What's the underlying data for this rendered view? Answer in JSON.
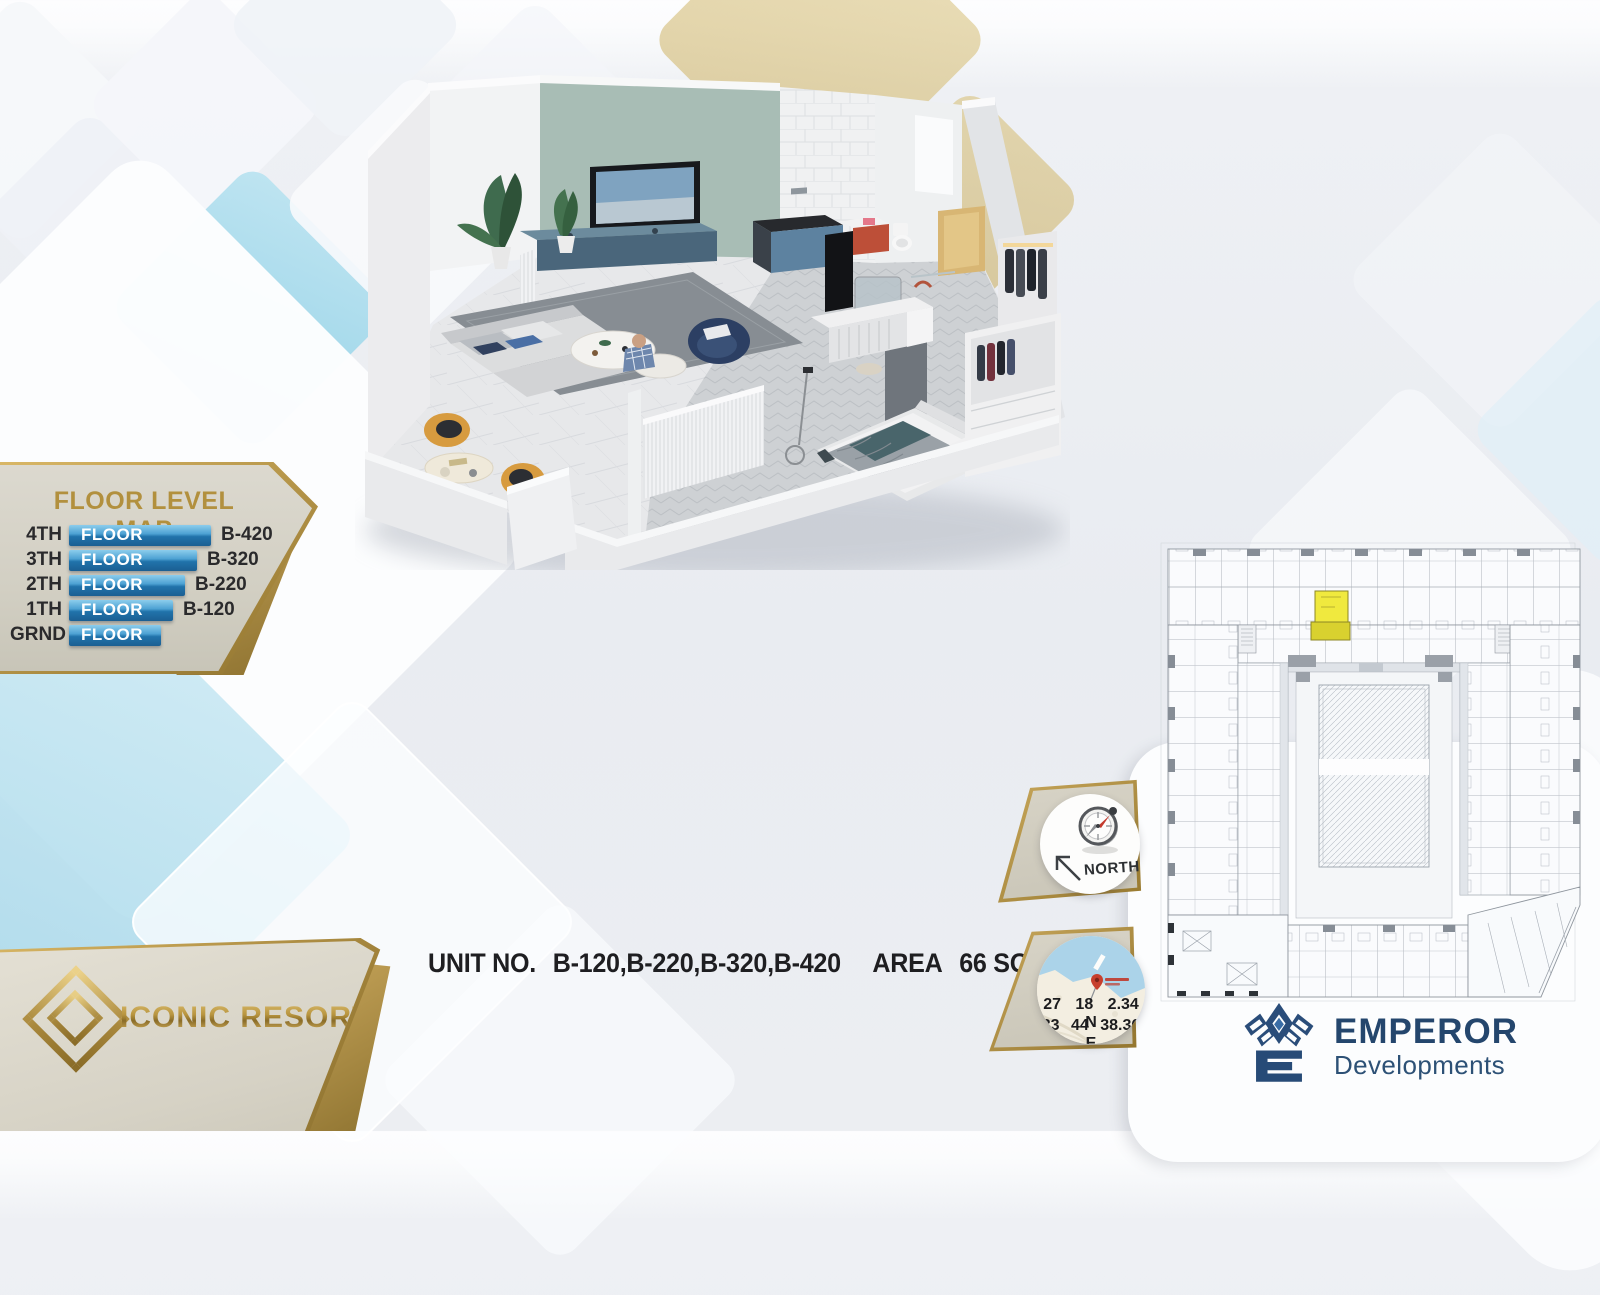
{
  "floor_level_map": {
    "title": "FLOOR LEVEL MAP",
    "rows": [
      {
        "level": "4TH",
        "floor_label": "FLOOR",
        "unit": "B-420"
      },
      {
        "level": "3TH",
        "floor_label": "FLOOR",
        "unit": "B-320"
      },
      {
        "level": "2TH",
        "floor_label": "FLOOR",
        "unit": "B-220"
      },
      {
        "level": "1TH",
        "floor_label": "FLOOR",
        "unit": "B-120"
      },
      {
        "level": "GRND",
        "floor_label": "FLOOR",
        "unit": ""
      }
    ]
  },
  "brand": {
    "name": "ICONIC RESORT"
  },
  "unit_info": {
    "label": "UNIT NO.",
    "units": "B-120,B-220,B-320,B-420",
    "area_label": "AREA",
    "area_value": "66 SQM"
  },
  "compass": {
    "label": "NORTH"
  },
  "location": {
    "line1": "27 18 2.34 N",
    "line2": "33 44 38.36 E"
  },
  "developer": {
    "name": "EMPEROR",
    "division": "Developments"
  },
  "floor_plan": {
    "highlighted_unit_color": "#ede63a"
  },
  "colors": {
    "gold": "#b2903e",
    "bar_blue": "#2f87c0",
    "navy": "#274b77",
    "accent_wall": "#a8bdb5",
    "highlight_yellow": "#ede63a"
  }
}
